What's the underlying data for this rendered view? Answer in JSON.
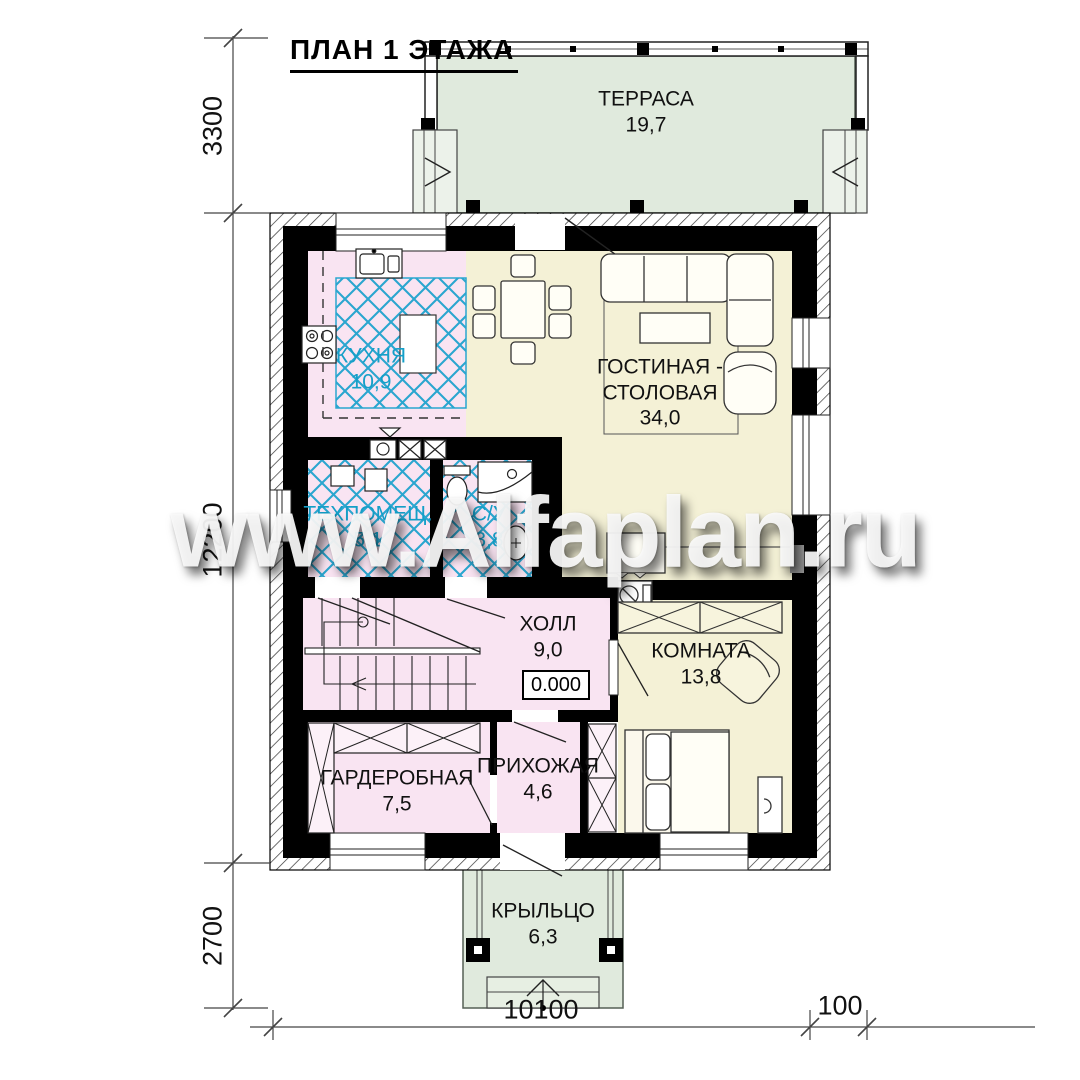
{
  "title": "ПЛАН 1 ЭТАЖА",
  "watermark": "www.Alfaplan.ru",
  "rooms": {
    "terrace": {
      "name": "ТЕРРАСА",
      "area": "19,7"
    },
    "kitchen": {
      "name": "КУХНЯ",
      "area": "10,9"
    },
    "living": {
      "name1": "ГОСТИНАЯ -",
      "name2": "СТОЛОВАЯ",
      "area": "34,0"
    },
    "tech": {
      "name": "ТЕХПОМЕЩ.",
      "area": "5,1"
    },
    "bath": {
      "name": "С/У",
      "area": "3,8"
    },
    "hall": {
      "name": "ХОЛЛ",
      "area": "9,0",
      "elevation": "0.000"
    },
    "bedroom": {
      "name": "КОМНАТА",
      "area": "13,8"
    },
    "wardrobe": {
      "name": "ГАРДЕРОБНАЯ",
      "area": "7,5"
    },
    "entry": {
      "name": "ПРИХОЖАЯ",
      "area": "4,6"
    },
    "porch": {
      "name": "КРЫЛЬЦО",
      "area": "6,3"
    }
  },
  "dimensions": {
    "left_top": "3300",
    "left_middle": "12200",
    "left_bottom": "2700",
    "bottom_main": "10100",
    "bottom_right": "100"
  },
  "colors": {
    "room_pink": "#f9e4f2",
    "room_yellow": "#f4f1d6",
    "outdoor_green": "#e0eadd",
    "tile_blue": "#2aa6cf",
    "wall": "#000000"
  }
}
